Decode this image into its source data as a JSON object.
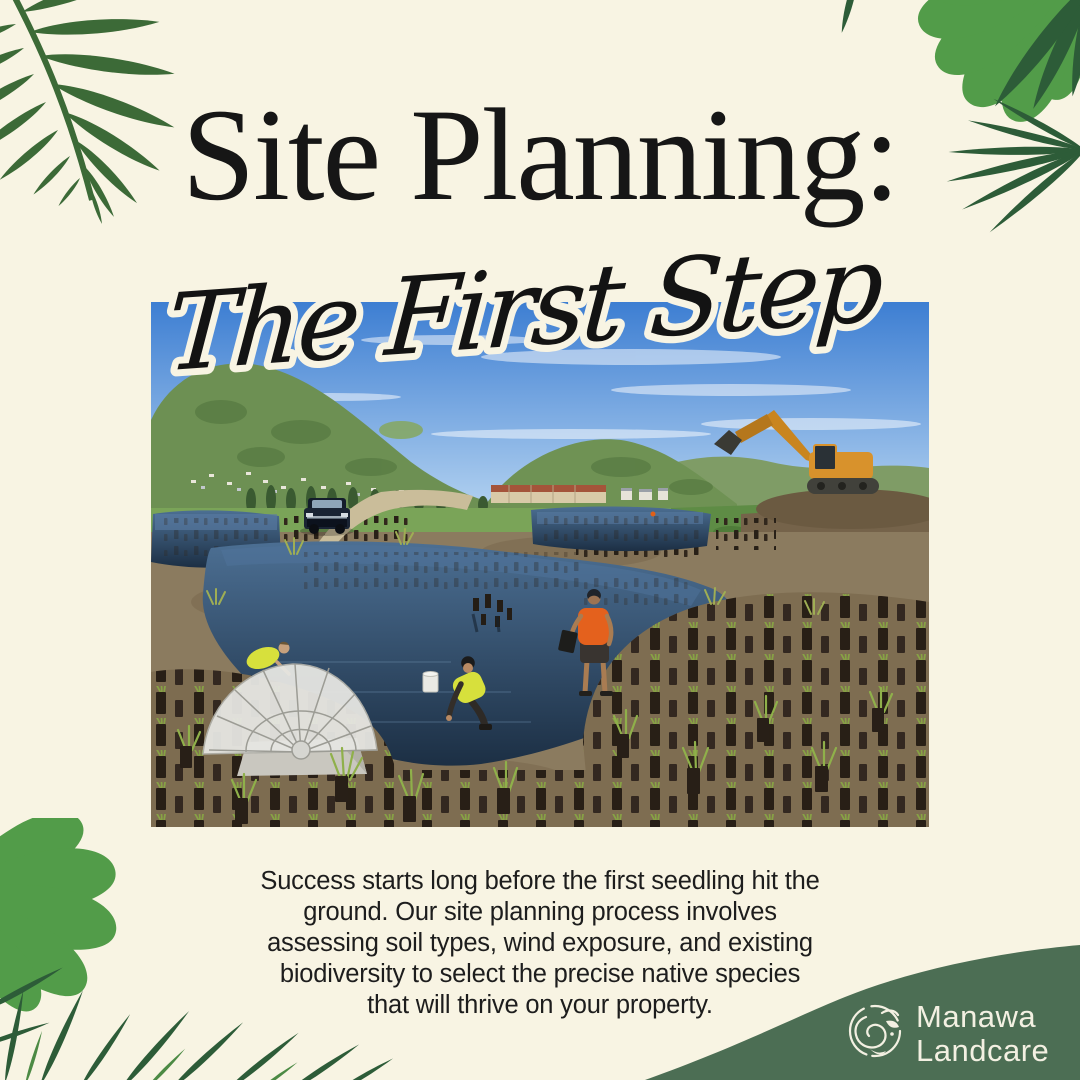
{
  "page": {
    "background_color": "#f8f4e3"
  },
  "header": {
    "title": "Site Planning:",
    "subtitle": "The First Step",
    "title_color": "#161616"
  },
  "photo": {
    "description": "Wetland restoration site: workers in hi-vis vests and an orange singlet planting native seedlings in brown protective sleeves beside dark ponds, a white dome grate over a culvert, a dark pickup truck on a dirt track, an orange excavator working below green hills dotted with houses under a blue sky"
  },
  "body": {
    "lines": [
      "Success starts long before the first seedling hit the",
      "ground. Our site planning process involves",
      "assessing soil types, wind exposure, and existing",
      "biodiversity to select the precise native species",
      "that will thrive on your property."
    ]
  },
  "brand": {
    "name_line1": "Manawa",
    "name_line2": "Landcare",
    "wave_color": "#4c6e54",
    "text_color": "#f3f0e2",
    "logo": "koru-spiral-icon"
  },
  "decor": {
    "palm_leaf_green": "#3c6a37",
    "monstera_green": "#529c49",
    "frond_green": "#2d5c38"
  }
}
